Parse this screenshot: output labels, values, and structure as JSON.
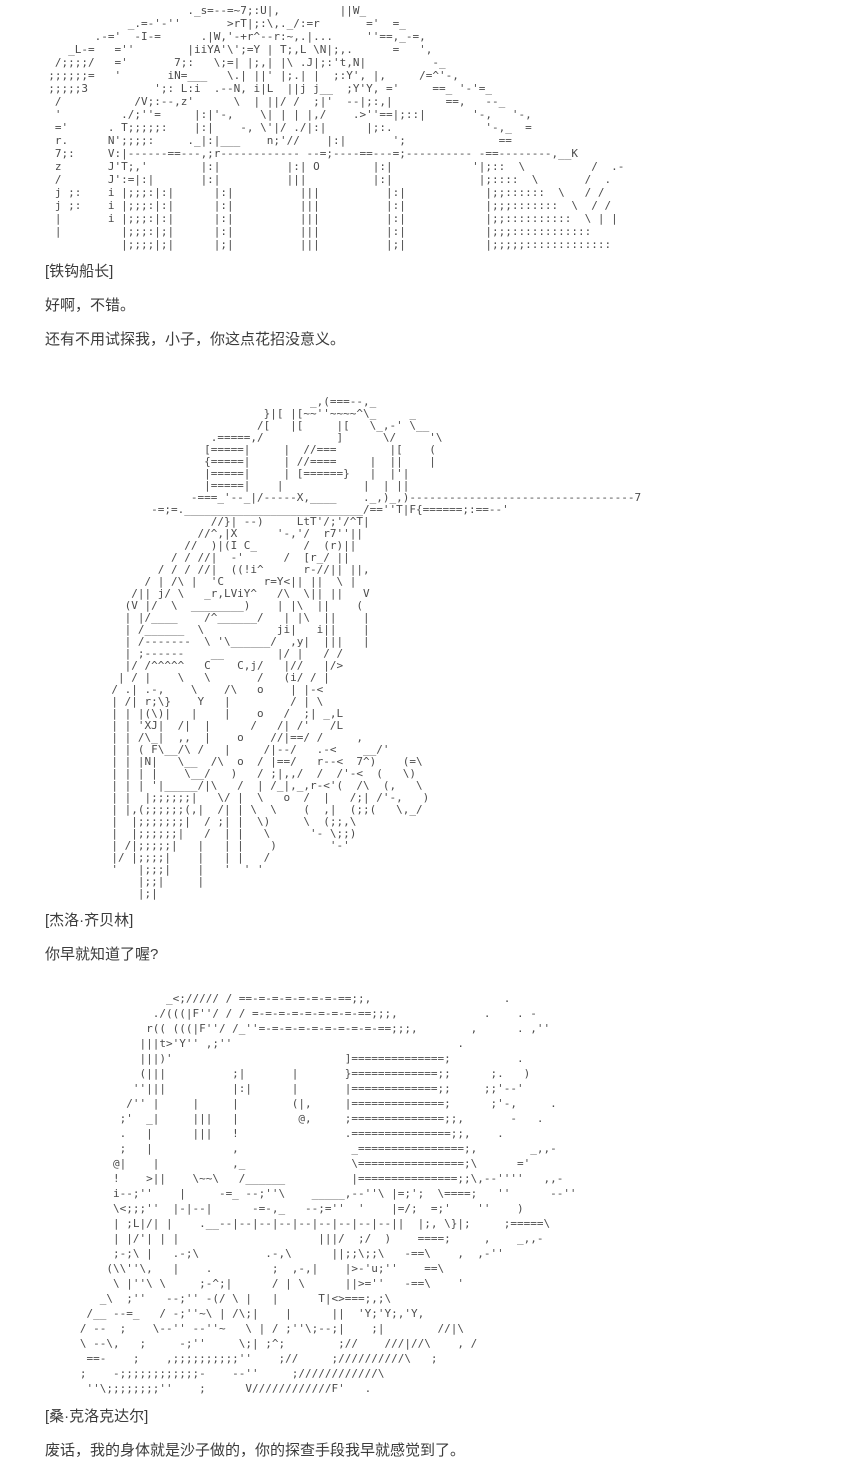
{
  "page": {
    "background": "#ffffff",
    "text_color": "#3b3b3b",
    "ascii_color": "#4b4b4b"
  },
  "sections": [
    {
      "art_label": "captain-hook-ascii-art",
      "speaker": "[铁钩船长]",
      "lines": [
        "好啊，不错。",
        "还有不用试探我，小子，你这点花招没意义。"
      ],
      "ascii_art": [
        "                       ._s=--=~7;:U|,         ||W_",
        "              _.=-'-''       >rT|;:\\,._/:=r       ='  =_",
        "         .-='  -I-=      .|W,'-+r^--r:~,.|...     ''==,_-=,",
        "     _L-=   =''        |iiYA'\\';=Y | T;,L \\N|;,.      =   ',",
        "   /;;;;/   ='       7;:   \\;=| |;,| |\\ .J|;:'t,N|          -_",
        "  ;;;;;;=   '       iN=___   \\.| ||' |;.| |  ;:Y', |,     /=^'-,",
        "  ;;;;;3          ';: L:i  .--N, i|L  ||j j__  ;Y'Y, ='     ==_ '-'=_",
        "   /           /V;:--,z'      \\  | ||/ /  ;|'  --|;:,|        ==,   --_",
        "   '         ./;''=     |:|'-,    \\| | | |,/    .>''==|;::|       '-,   '-,",
        "   ='      . T;;;;;:    |:|    -, \\'|/ ./|:|      |;:.              '-,_  =",
        "   r.      N';;;;:     ._|:|___    n;'//    |:|       ';              ==",
        "   7;:     V:|------==---,;r------------ --=;----==---=;---------- -==--------,__K",
        "   z       J'T;,'        |:|          |:| O        |:|            '|;::  \\          /  .-",
        "   /       J':=|:|       |:|          |||          |:|             |;::::  \\       /  .",
        "   j ;:    i |;;;:|:|      |:|          |||          |:|            |;;::::::  \\   / /",
        "   j ;:    i |;;;:|:|      |:|          |||          |:|            |;;;:::::::  \\  / /",
        "   |       i |;;;:|:|      |:|          |||          |:|            |;;::::::::::  \\ | |",
        "   |         |;;;:|;|      |:|          |||          |:|            |;;;::::::::::::",
        "             |;;;;|;|      |;|          |||          |;|            |;;;;;:::::::::::::"
      ]
    },
    {
      "art_label": "gyro-zeppeli-ascii-art",
      "speaker": "[杰洛·齐贝林]",
      "lines": [
        "你早就知道了喔?"
      ],
      "ascii_art": [
        "                                     _,(===--,_",
        "                              }|[ |[~~''~~~~^\\_     _",
        "                             /[   |[     |[   \\_,-' \\__",
        "                      .=====,/           ]      \\/     '\\",
        "                     [=====|     |  //===        |[    (",
        "                     {=====|     | //====     |  ||    |",
        "                     |=====|     | [======}   |  |'|",
        "                     |=====|    |            |  | ||",
        "                   -===_'--_|/-----X,____    ._,)_,)----------------------------------7",
        "             -=;=.___________________________/==''T|F{======;:==--'",
        "                      //}| --)     LtT'/;'/^T|",
        "                    //^,|X      '-,'/  r7''||",
        "                  //  )|(I C_       /  (r)||",
        "                / / //|  -'      /  [r_/ ||",
        "              / / / //|  ((!i^      r-//|| ||,",
        "            / | /\\ |  'C      r=Y<|| ||  \\ |",
        "          /|| j/ \\   _r,LViY^   /\\  \\|| ||   V",
        "         (V |/  \\  ________)    | |\\  ||    (",
        "         | |/____    /^______/   | |\\  ||    |",
        "         | /______  \\           ji|   i||    |",
        "         | /-------  \\ '\\______/  ,y|  |||   |",
        "         | ;------    __        |/ |   / /",
        "         |/ /^^^^^   C    C,j/   |//   |/>",
        "        | / |    \\   \\       /   (i/ / |",
        "       / .| .-,    \\    /\\   o    | |-<",
        "       | /| r;\\}    Y   |         / | \\",
        "       | | |(\\)|   |    |    o   /  ;| _,L",
        "       | | 'XJ|  /|  |      /   /| /'   /L",
        "       | | /\\_|  ,,  |    o    //|==/ /     ,",
        "       | | ( F\\__/\\ /   |     /|--/   .-<    __/'",
        "       | | |N|   \\__  /\\  o  / |==/   r--<  7^)    (=\\",
        "       | | | |    \\__/   )   / ;|,,/  /  /'-<  (   \\)",
        "       | | | '|_____/|\\   /  | /_|,_,r-<'(  /\\  (,   \\",
        "       | |  |;;;;;;|   \\/ |  \\   o  /  |   /;| /'-,   )",
        "       | |,(;;;;;;(,|  /| | \\  \\    (  ,|  (;;(   \\,_/",
        "       |  |;;;;;;;|  / ;| |  \\)     \\  (;;,\\",
        "       |  |;;;;;;|   /  | |   \\      '- \\;;)",
        "       | /|;;;;;|   |   | |    )        '-'",
        "       |/ |;;;;|    |   | |   /",
        "       '   |;;;|    |   '  ' '",
        "           |;;|     |",
        "           |;|"
      ]
    },
    {
      "art_label": "crocodile-ascii-art",
      "speaker": "[桑·克洛克达尔]",
      "lines": [
        "废话，我的身体就是沙子做的，你的探查手段我早就感觉到了。"
      ],
      "ascii_art": [
        "                _<;///// / ==-=-=-=-=-=-=-==;;,                    .",
        "              ./(((|F''/ / / =-=-=-=-=-=-=-=-==;;;,             .    . -",
        "             r(( (((|F''/ /_''=-=-=-=-=-=-=-=-=-==;;;,        ,      . ,''",
        "            |||t>'Y'' ,;''                                  .",
        "            |||)'                          ]==============;          .",
        "            (|||          ;|       |       }=============;;      ;.   )",
        "           ''|||          |:|      |       |=============;;     ;;'--'",
        "          /'' |     |     |        (|,     |==============;      ;'-,     .",
        "         ;'  _|     |||   |         @,     ;==============;;,       -   .",
        "         .   |      |||   !                .===============;;,    .",
        "         ;   |            ,                 _================;,        _,,-",
        "        @|    |           ,_                \\================;\\      ='",
        "        !    >||    \\~~\\   /______          |===============;;\\,--''''   ,,-",
        "        i--;''    |     -=_ --;''\\    _____,--''\\ |=;';  \\====;   ''      --''",
        "        \\<;;;''  |-|--|      -=-,_   --;=''  '    |=/;  =;'    ''    )",
        "        | ;L|/| |    .__--|--|--|--|--|--|--|--|--||  |;, \\}|;     ;=====\\",
        "        | |/'| | |                     |||/  ;/  )    ====;     ,    _,,-",
        "        ;-;\\ |   .-;\\          .-,\\      ||;;\\;;\\   -==\\    ,  ,-''",
        "       (\\\\''\\,   |    .         ;  ,-,|    |>-'u;''    ==\\",
        "        \\ |''\\ \\     ;-^;|      / | \\      ||>=''   -==\\    '",
        "      _\\  ;''   --;'' -(/ \\ |   |      T|<>===;,;\\",
        "    /__ --=_   / -;''~\\ | /\\;|    |      ||  'Y;'Y;,'Y,",
        "   / --  ;    \\--'' --''~   \\ | / ;''\\;--;|    ;|        //|\\",
        "   \\ --\\,   ;     -;''     \\;| ;^;        ;//    ///|//\\    , /",
        "    ==-    ;    ,;;;;;;;;;;''    ;//     ;//////////\\   ;",
        "   ;    -;;;;;;;;;;;;-    --''     ;////////////\\",
        "    ''\\;;;;;;;;''    ;      V////////////F'   ."
      ]
    }
  ]
}
